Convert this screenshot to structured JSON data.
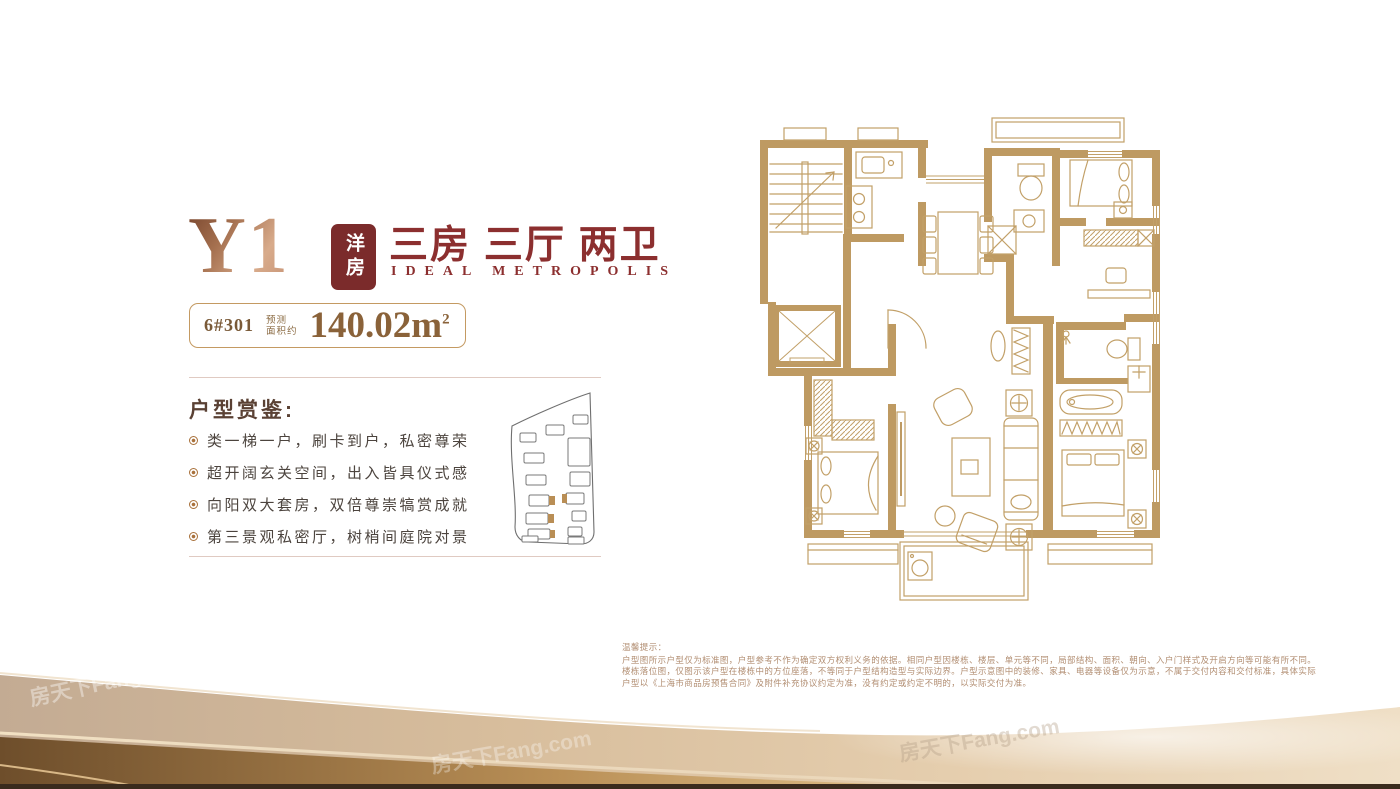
{
  "header": {
    "unit_code": "Y1",
    "badge": "洋房",
    "title_cn": "三房 三厅 两卫",
    "title_en": "IDEAL METROPOLIS"
  },
  "area": {
    "building_room": "6#301",
    "approx_label_line1": "预测",
    "approx_label_line2": "面积约",
    "value": "140.02",
    "unit_base": "m",
    "unit_sup": "2"
  },
  "features": {
    "heading": "户型赏鉴:",
    "items": [
      "类一梯一户，刷卡到户，私密尊荣",
      "超开阔玄关空间，出入皆具仪式感",
      "向阳双大套房，双倍尊崇犒赏成就",
      "第三景观私密厅，树梢间庭院对景"
    ]
  },
  "disclaimer": {
    "title": "温馨提示：",
    "body": "户型图所示户型仅为标准图，户型参考不作为确定双方权利义务的依据。相同户型因楼栋、楼层、单元等不同，局部结构、面积、朝向、入户门样式及开启方向等可能有所不同。楼栋落位图，仅图示该户型在楼栋中的方位座落，不等同于户型结构造型与实际边界。户型示意图中的装修、家具、电器等设备仅为示意，不属于交付内容和交付标准，具体实际户型以《上海市商品房预售合同》及附件补充协议约定为准，没有约定或约定不明的，以实际交付为准。"
  },
  "watermark": "房天下Fang.com",
  "colors": {
    "accent_red": "#8C2F2F",
    "badge_bg": "#7B2B2B",
    "wall_gold": "#BE9A62",
    "line_gold": "#C2A068",
    "area_text": "#8A6239",
    "heading_brown": "#5A4134",
    "body_text": "#4C443E",
    "divider": "#E0CAC2",
    "disclaimer_text": "#B28E72",
    "bottom_bar": "#3A2B1D"
  }
}
